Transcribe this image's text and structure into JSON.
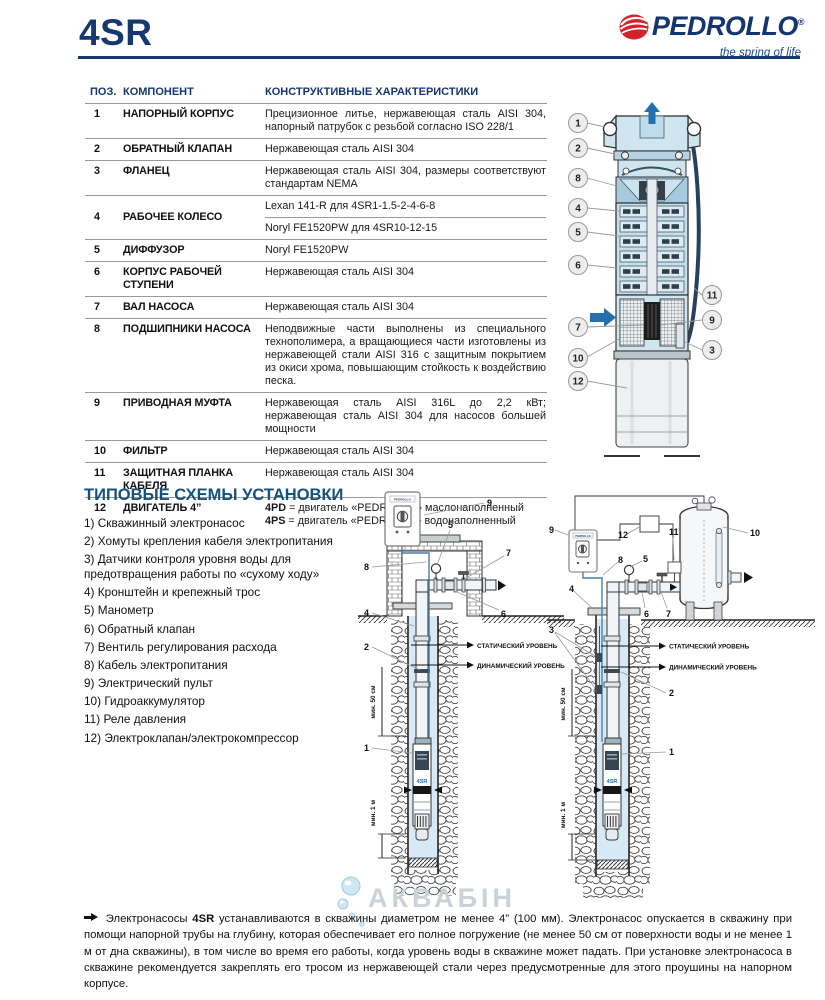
{
  "colors": {
    "navy": "#17386e",
    "section_blue": "#15517e",
    "accent_blue": "#2470ae",
    "brand_red": "#d2232a",
    "pump_light_blue": "#cfe6f1",
    "water_blue": "#d7e9f4"
  },
  "header": {
    "model": "4SR",
    "brand": "PEDROLLO",
    "reg": "®",
    "tagline": "the spring of life"
  },
  "components_table": {
    "columns": {
      "pos": "ПОЗ.",
      "component": "КОМПОНЕНТ",
      "characteristics": "КОНСТРУКТИВНЫЕ ХАРАКТЕРИСТИКИ"
    },
    "rows": [
      {
        "num": "1",
        "name": "НАПОРНЫЙ КОРПУС",
        "desc": "Прецизионное литье, нержавеющая сталь AISI 304, напорный патрубок с резьбой согласно ISO 228/1"
      },
      {
        "num": "2",
        "name": "ОБРАТНЫЙ КЛАПАН",
        "desc": "Нержавеющая сталь AISI 304"
      },
      {
        "num": "3",
        "name": "ФЛАНЕЦ",
        "desc": "Нержавеющая сталь AISI 304, размеры соответствуют стандартам NEMA"
      },
      {
        "num": "4",
        "name": "РАБОЧЕЕ КОЛЕСО",
        "desc_a": "Lexan 141-R для 4SR1-1.5-2-4-6-8",
        "desc_b": "Noryl FE1520PW для 4SR10-12-15"
      },
      {
        "num": "5",
        "name": "ДИФФУЗОР",
        "desc": "Noryl FE1520PW"
      },
      {
        "num": "6",
        "name": "КОРПУС РАБОЧЕЙ СТУПЕНИ",
        "desc": "Нержавеющая сталь AISI 304"
      },
      {
        "num": "7",
        "name": "ВАЛ НАСОСА",
        "desc": "Нержавеющая сталь AISI 304"
      },
      {
        "num": "8",
        "name": "ПОДШИПНИКИ НАСОСА",
        "desc": "Неподвижные части выполнены из специального технополимера, а вращающиеся части изготовлены из нержавеющей стали AISI 316 с защитным покрытием из окиси хрома, повышающим стойкость к воздействию песка."
      },
      {
        "num": "9",
        "name": "ПРИВОДНАЯ МУФТА",
        "desc": "Нержавеющая сталь AISI 316L до 2,2 кВт; нержавеющая сталь AISI 304 для насосов большей мощности"
      },
      {
        "num": "10",
        "name": "ФИЛЬТР",
        "desc": "Нержавеющая сталь AISI 304"
      },
      {
        "num": "11",
        "name": "ЗАЩИТНАЯ ПЛАНКА КАБЕЛЯ",
        "desc": "Нержавеющая сталь AISI 304"
      },
      {
        "num": "12",
        "name": "ДВИГАТЕЛЬ 4”",
        "line1_code": "4PD",
        "line1_text": "= двигатель «PEDROLLO» маслонаполненный",
        "line2_code": "4PS",
        "line2_text": "= двигатель «PEDROLLO» водонаполненный"
      }
    ]
  },
  "pump_figure": {
    "callouts": [
      "1",
      "2",
      "8",
      "4",
      "5",
      "6",
      "7",
      "10",
      "12",
      "11",
      "9",
      "3"
    ]
  },
  "installation": {
    "title": "ТИПОВЫЕ СХЕМЫ УСТАНОВКИ",
    "legend": [
      "1) Скважинный электронасос",
      "2) Хомуты крепления кабеля электропитания",
      "3) Датчики контроля уровня воды для предотвращения работы по «сухому ходу»",
      "4) Кронштейн и крепежный трос",
      "5) Манометр",
      "6) Обратный клапан",
      "7) Вентиль регулирования расхода",
      "8) Кабель электропитания",
      "9) Электрический пульт",
      "10) Гидроаккумулятор",
      "11) Реле давления",
      "12) Электроклапан/электрокомпрессор"
    ],
    "labels": {
      "static_level": "СТАТИЧЕСКИЙ УРОВЕНЬ",
      "dynamic_level": "ДИНАМИЧЕСКИЙ УРОВЕНЬ",
      "min_50cm": "мин. 50 см",
      "min_1m": "мин. 1 м",
      "pump_model": "4SR",
      "panel_brand": "PEDROLLO"
    },
    "left_diagram": {
      "callouts": [
        "9",
        "5",
        "7",
        "8",
        "4",
        "6",
        "2",
        "1"
      ]
    },
    "right_diagram": {
      "callouts": [
        "9",
        "12",
        "11",
        "10",
        "5",
        "8",
        "4",
        "3",
        "6",
        "7",
        "2",
        "1"
      ]
    }
  },
  "watermark": {
    "text": "АКВАБІН"
  },
  "footer_note": {
    "lead": "Электронасосы",
    "model": "4SR",
    "body": "устанавливаются в скважины диаметром не менее 4” (100 мм). Электронасос опускается в скважину при помощи напорной трубы на глубину, которая обеспечивает его полное погружение (не менее 50 см от поверхности воды и не менее 1 м от дна скважины), в том числе во время его работы, когда уровень воды в скважине может падать. При установке электронасоса в скважине рекомендуется закреплять его тросом из нержавеющей стали через предусмотренные для этого проушины на напорном корпусе."
  }
}
